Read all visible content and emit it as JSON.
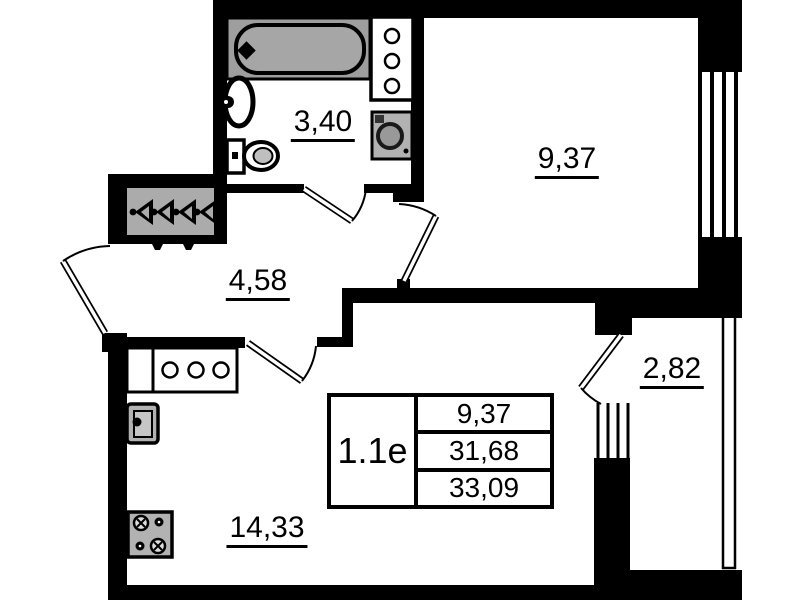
{
  "plan": {
    "unit_label": "1.1е",
    "info_table": {
      "rows": [
        "9,37",
        "31,68",
        "33,09"
      ]
    },
    "rooms": {
      "bathroom": {
        "area": "3,40"
      },
      "bedroom": {
        "area": "9,37"
      },
      "hallway": {
        "area": "4,58"
      },
      "balcony": {
        "area": "2,82"
      },
      "kitchen_living": {
        "area": "14,33"
      }
    },
    "colors": {
      "wall": "#000000",
      "background": "#ffffff",
      "fixture_gray": "#a8a8a8"
    }
  }
}
